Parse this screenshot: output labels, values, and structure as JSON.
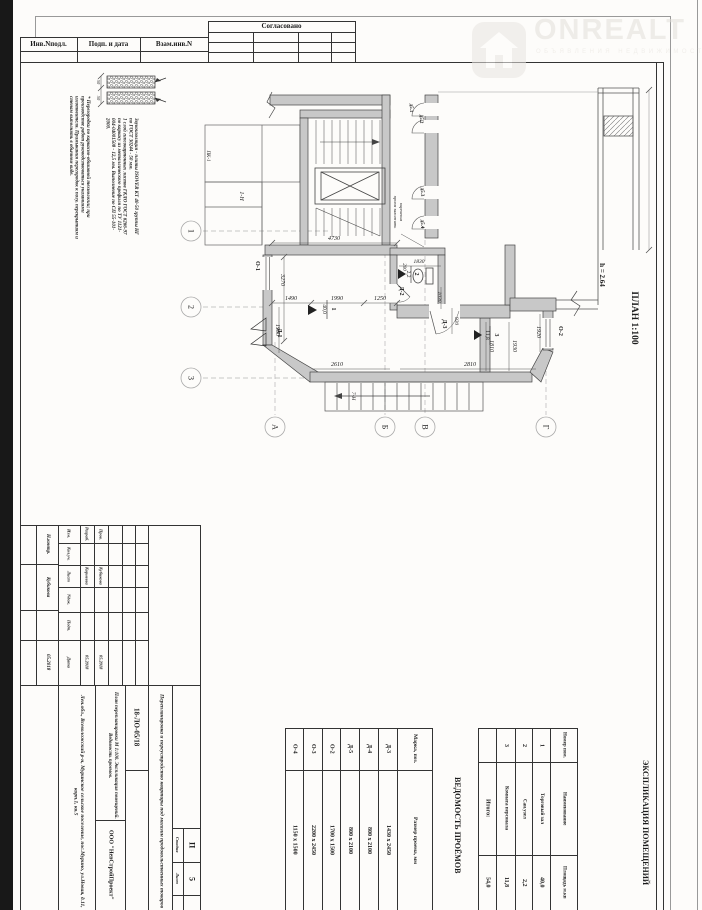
{
  "stamp_top": {
    "approved": "Согласовано",
    "col1": "Инв.Nподл.",
    "col2": "Подп. и дата",
    "col3": "Взам.инв.N"
  },
  "watermark": {
    "brand": "ONREALT",
    "subtitle": "ОБЪЯВЛЕНИЯ НЕДВИЖИМОСТИ"
  },
  "notes": {
    "note1": "Звукоизоляция - плиты ISOVER КТ 40-50 группы НГ по ГОСТ 30244  -  50 мм.",
    "note2": "1 слой гипсокартонных листов ГКЛО ГОСТ 6266-97 по каркасу из металлического профиля по ТУ 1121-004-04001508  -  12,5 мм. Выполнение по СП 55-101-2000.",
    "note3": "* Перегородки по каркасно-обшивной технологии; при производстве работ руководствоваться указаниями изготовителя. Примыкания перегородок к полу, перекрытиям и стенам выполнять в обычном виде."
  },
  "plan": {
    "title": "ПЛАН 1:100",
    "h": "h = 2.64",
    "dims": {
      "d4730": "4730",
      "d3270": "3270",
      "d1490": "1490",
      "d1990": "1990",
      "d1250": "1250",
      "d1900": "1900",
      "d2610": "2610",
      "d2810": "2810",
      "d1830": "1830",
      "d1030": "1030",
      "d920": "920",
      "d200": "200",
      "d1810": "1810",
      "d1930": "1930",
      "d1920": "1920",
      "d50a": "50",
      "d50b": "50"
    },
    "axes": {
      "a1": "1",
      "a2": "2",
      "a3": "3",
      "aA": "А",
      "aB": "Б",
      "aV": "В",
      "aG": "Г"
    },
    "openings": {
      "o1": "О-1",
      "o2": "О-2",
      "d1": "Д-1",
      "d2": "Д-2",
      "d3": "Д-3",
      "d51": "д5.1",
      "d52": "д5.2",
      "d53": "д5.3",
      "d54": "д5.4"
    },
    "rooms": {
      "r1n": "1",
      "r1a": "40,0",
      "r2n": "2",
      "r2a": "2,2",
      "r3n": "3",
      "r3a": "11,8"
    },
    "labels": {
      "pk1": "ПК-1",
      "n1": "1-Н",
      "n7": "7-Н",
      "brick1": "проем заложить",
      "brick2": "кирпичом"
    }
  },
  "titleblock": {
    "doc_number": "18-ЛО-05/18",
    "address": "Лен.обл., Всеволожский р-н, Муринское сельское поселение, пос.Мурино, ул.Новая, д.11, корп.1, кв.5",
    "project_title": "Перепланировка и переустройство квартиры под магазин продовольственных товаров",
    "sheet_contents": "План перепланировки М 1:100. Экспликация помещений. Ведомость проемов.",
    "company": "ООО \"НевСтройПроект\"",
    "stage_label": "Стадия",
    "stage": "П",
    "sheet_label": "Лист",
    "sheet": "5",
    "header_cols": [
      "Изм.",
      "Кол.уч.",
      "Лист",
      "Nдок.",
      "Подп.",
      "Дата"
    ],
    "rows": [
      {
        "role": "Разраб.",
        "name": "Корнеева",
        "date": "05.2018"
      },
      {
        "role": "Пров.",
        "name": "Кубикова",
        "date": "05.2018"
      }
    ],
    "ncontr": {
      "role": "Н.контр.",
      "name": "Кубикова",
      "date": "05.2018"
    }
  },
  "openings_table": {
    "title": "ВЕДОМОСТЬ ПРОЁМОВ",
    "col1": "Марка, поз.",
    "col2": "Размер проема, мм",
    "rows": [
      [
        "Д-3",
        "1430 х 2450"
      ],
      [
        "Д-4",
        "800 х 2100"
      ],
      [
        "Д-5",
        "800 х 2100"
      ],
      [
        "О-2",
        "1700 х 1500"
      ],
      [
        "О-3",
        "2200 х 2450"
      ],
      [
        "О-4",
        "1150 х 1500"
      ]
    ]
  },
  "rooms_table": {
    "title": "ЭКСПЛИКАЦИЯ ПОМЕЩЕНИЙ",
    "col1": "Номер пом.",
    "col2": "Наименование",
    "col3": "Площадь м.кв",
    "rows": [
      [
        "1",
        "Торговый зал",
        "40,0"
      ],
      [
        "2",
        "Сан.узел",
        "2,2"
      ],
      [
        "3",
        "Комната персонала",
        "11,8"
      ]
    ],
    "total_label": "Итого:",
    "total": "54,0"
  }
}
